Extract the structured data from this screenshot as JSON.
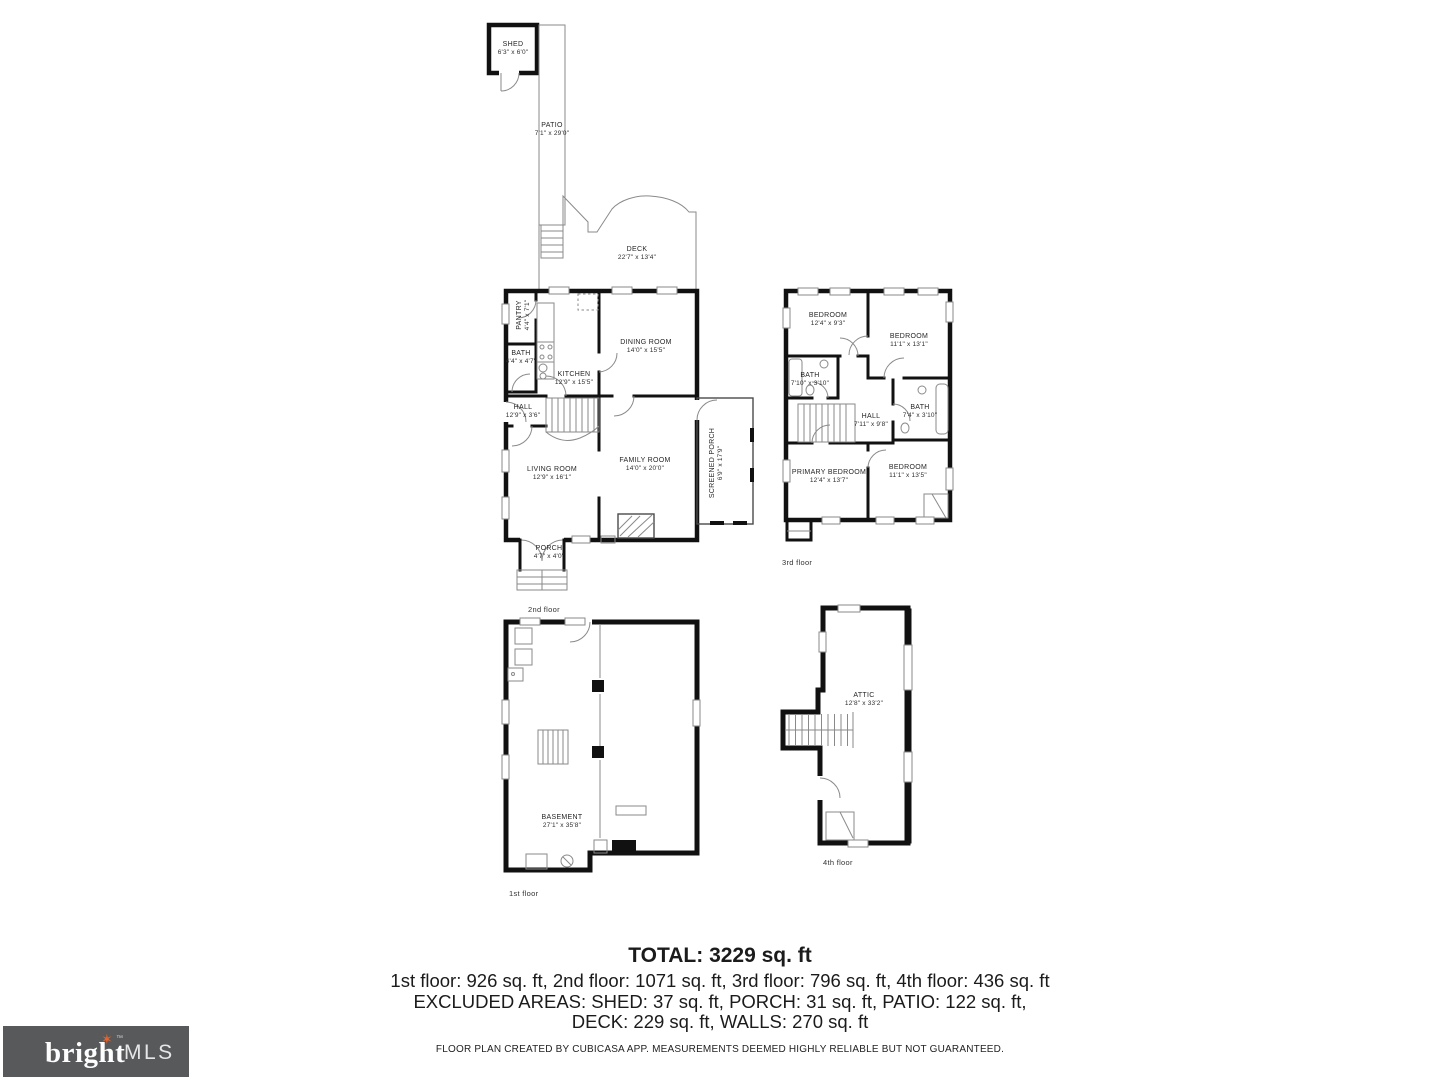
{
  "rooms": {
    "shed": {
      "name": "SHED",
      "dims": "6'3\" x 6'0\""
    },
    "patio": {
      "name": "PATIO",
      "dims": "7'1\" x 29'0\""
    },
    "deck": {
      "name": "DECK",
      "dims": "22'7\" x 13'4\""
    },
    "pantry": {
      "name": "PANTRY",
      "dims": "4'4\" x 7'1\""
    },
    "bath_2f": {
      "name": "BATH",
      "dims": "4'4\" x 4'7\""
    },
    "kitchen": {
      "name": "KITCHEN",
      "dims": "12'9\" x 15'5\""
    },
    "dining_room": {
      "name": "DINING ROOM",
      "dims": "14'0\" x 15'5\""
    },
    "hall_2f": {
      "name": "HALL",
      "dims": "12'9\" x 3'6\""
    },
    "living_room": {
      "name": "LIVING ROOM",
      "dims": "12'9\" x 16'1\""
    },
    "family_room": {
      "name": "FAMILY ROOM",
      "dims": "14'0\" x 20'0\""
    },
    "screened_porch": {
      "name": "SCREENED PORCH",
      "dims": "6'9\" x 17'9\""
    },
    "porch": {
      "name": "PORCH",
      "dims": "4'7\" x 4'0\""
    },
    "bedroom_3f_nw": {
      "name": "BEDROOM",
      "dims": "12'4\" x 9'3\""
    },
    "bedroom_3f_ne": {
      "name": "BEDROOM",
      "dims": "11'1\" x 13'1\""
    },
    "bath_3f_left": {
      "name": "BATH",
      "dims": "7'10\" x 3'10\""
    },
    "hall_3f": {
      "name": "HALL",
      "dims": "7'11\" x 9'8\""
    },
    "bath_3f_right": {
      "name": "BATH",
      "dims": "7'4\" x 3'10\""
    },
    "primary_bedroom": {
      "name": "PRIMARY BEDROOM",
      "dims": "12'4\" x 13'7\""
    },
    "bedroom_3f_se": {
      "name": "BEDROOM",
      "dims": "11'1\" x 13'5\""
    },
    "basement": {
      "name": "BASEMENT",
      "dims": "27'1\" x 35'8\""
    },
    "attic": {
      "name": "ATTIC",
      "dims": "12'8\" x 33'2\""
    }
  },
  "floor_captions": {
    "first": "1st floor",
    "second": "2nd floor",
    "third": "3rd floor",
    "fourth": "4th floor"
  },
  "summary": {
    "total": "TOTAL: 3229 sq. ft",
    "floors": "1st floor: 926 sq. ft, 2nd floor: 1071 sq. ft, 3rd floor: 796 sq. ft, 4th floor: 436 sq. ft",
    "excluded_line1": "EXCLUDED AREAS: SHED: 37 sq. ft, PORCH: 31 sq. ft, PATIO: 122 sq. ft,",
    "excluded_line2": "DECK: 229 sq. ft, WALLS: 270 sq. ft",
    "disclaimer": "FLOOR PLAN CREATED BY CUBICASA APP. MEASUREMENTS DEEMED HIGHLY RELIABLE BUT NOT GUARANTEED."
  },
  "logo": {
    "brand": "bright",
    "tm": "TM",
    "suffix": "MLS"
  },
  "colors": {
    "wall": "#111111",
    "thin_line": "#8a8a8a",
    "logo_bg": "#58595b",
    "logo_accent": "#e8622d",
    "text": "#1f1f1f"
  }
}
